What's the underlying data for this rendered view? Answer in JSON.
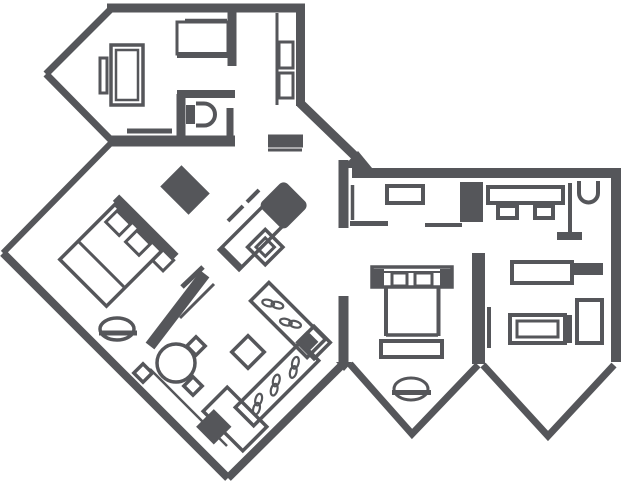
{
  "canvas": {
    "width": 621,
    "height": 486
  },
  "colors": {
    "wall": "#55565a",
    "background": "#ffffff"
  },
  "plan": {
    "type": "floor-plan",
    "title": "apartment-suite-floor-plan",
    "rooms": [
      {
        "name": "office-room",
        "location": "top-left",
        "furniture": [
          "desk",
          "desk-chair",
          "console-bench",
          "wardrobe-shelves",
          "wc-toilet"
        ]
      },
      {
        "name": "bedroom",
        "location": "left",
        "furniture": [
          "double-bed-rotated",
          "nightstand",
          "oval-stool",
          "sofa"
        ]
      },
      {
        "name": "living-dining",
        "location": "center-bottom",
        "furniture": [
          "round-table",
          "dining-chairs",
          "ottoman",
          "tv-cabinet",
          "decor-console-upper",
          "decor-console-lower"
        ]
      },
      {
        "name": "kitchenette",
        "location": "center",
        "furniture": [
          "fridge",
          "counter",
          "stove"
        ]
      },
      {
        "name": "entry-hall",
        "location": "center-top",
        "furniture": [
          "entry-rug"
        ]
      },
      {
        "name": "master-bedroom",
        "location": "right-center",
        "furniture": [
          "double-bed",
          "wall-picture",
          "ceiling-fixture",
          "bay-window"
        ]
      },
      {
        "name": "study-tv-room",
        "location": "right",
        "furniture": [
          "desk",
          "dresser",
          "tv",
          "armchair",
          "bay-window"
        ]
      },
      {
        "name": "bathroom-right",
        "location": "top-right",
        "furniture": [
          "toilet"
        ]
      }
    ]
  }
}
